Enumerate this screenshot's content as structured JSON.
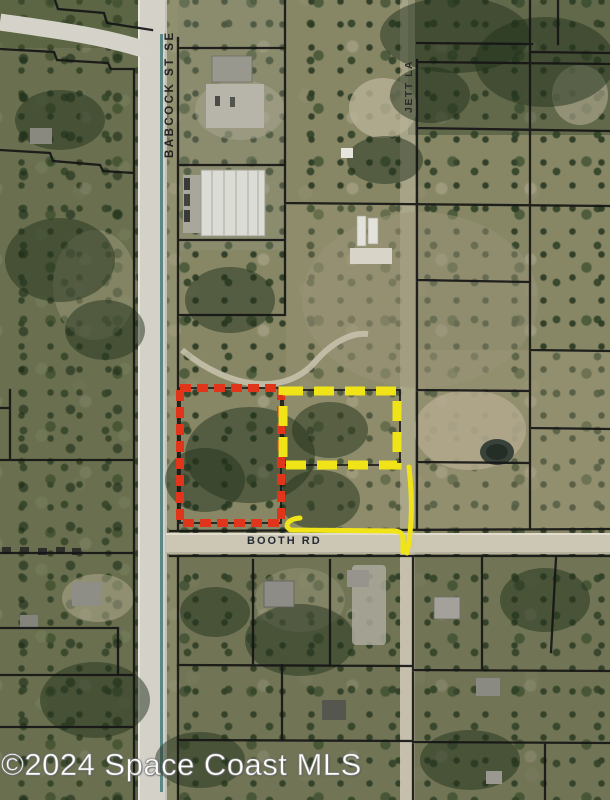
{
  "watermark": "©2024 Space Coast MLS",
  "roads": {
    "babcock": "BABCOCK ST SE",
    "jett": "JETT LA",
    "booth": "BOOTH RD"
  },
  "overlays": {
    "subject_color": "#e0351a",
    "adjacent_color": "#f0e418",
    "path_color": "#f0e418",
    "parcel_line_color": "#161616",
    "canal_color": "#4e7e7c"
  }
}
